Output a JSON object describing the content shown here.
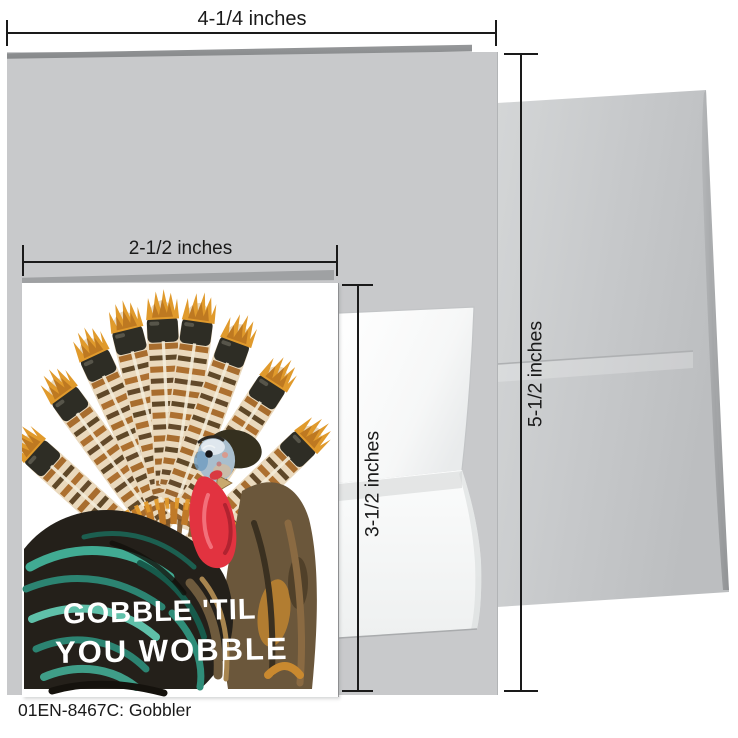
{
  "product": {
    "caption": "01EN-8467C: Gobbler"
  },
  "measurements": {
    "folded_card_width": "4-1/4 inches",
    "folded_card_height": "5-1/2 inches",
    "note_card_width": "2-1/2 inches",
    "note_card_height": "3-1/2 inches"
  },
  "small_card": {
    "message_line1": "GOBBLE 'TIL",
    "message_line2": "YOU WOBBLE",
    "illustration": "turkey-painting"
  },
  "palette": {
    "ink": "#1a1a1a",
    "card-gray": "#c8c9cb",
    "card-edge-gray": "#8f9193",
    "envelope-gray": "#cdcfd1",
    "envelope-white": "#fafbfb",
    "message-white": "#ffffff",
    "teal": "#41ab93",
    "wattle-red": "#e23340",
    "feather-rust": "#a86d2e",
    "feather-orange": "#e09a2c"
  }
}
